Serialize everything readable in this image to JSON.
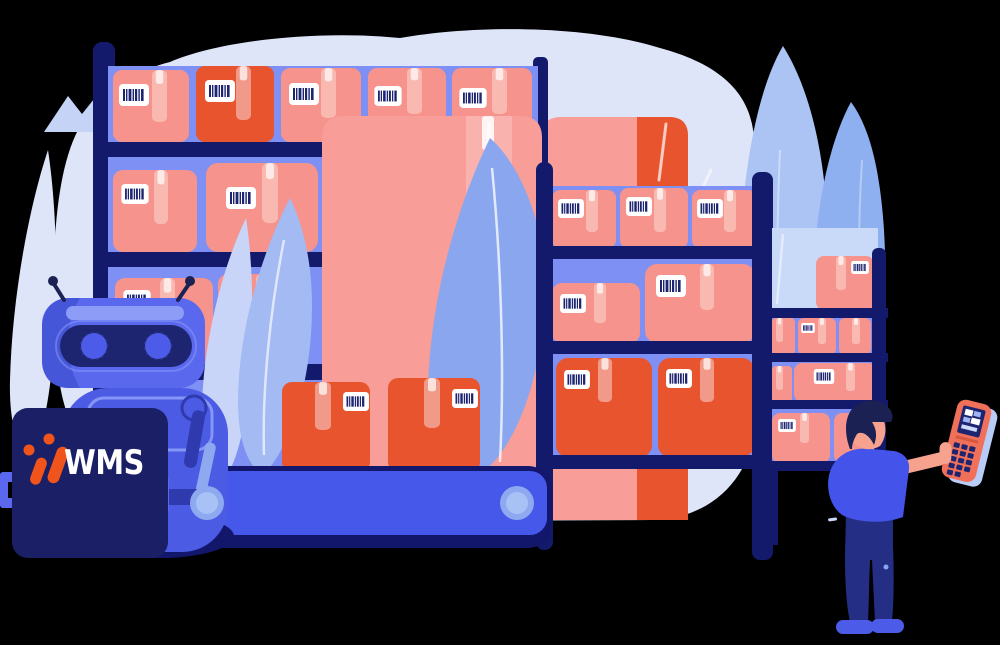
{
  "sign": {
    "logo_text": "WMS"
  },
  "palette": {
    "background": "#000000",
    "blob": "#dee5f8",
    "mound": "#c5d3f7",
    "teardrop_light": "#abc4f4",
    "teardrop_medium": "#8fb0f0",
    "leaf_light": "#c8d5f8",
    "leaf_medium": "#a3baf3",
    "leaf_big": "#8aa6ee",
    "shelf_panel": "#7e90f4",
    "shelf_panel_light": "#c9d9f8",
    "navy": "#131a6b",
    "box_salmon": "#f5938c",
    "box_orange": "#e8542d",
    "crate_pink": "#f89d97",
    "tape_salmon": "#f9b9b1",
    "tape_orange": "#f29a8a",
    "barcode_navy": "#1d2470",
    "conveyor_base": "#12176b",
    "conveyor_belt": "#4558ea",
    "roller_outer": "#8ea9ef",
    "roller_inner": "#a9c2f5",
    "robot_blue": "#5a68ee",
    "robot_dark": "#4656d8",
    "robot_body": "#4c5be4",
    "robot_highlight": "#8c9cf7",
    "visor_navy": "#1d2470",
    "eye_blue": "#4c5ce8",
    "sign_navy": "#1b2066",
    "logo_orange": "#f1541a",
    "logo_text_white": "#ffffff",
    "skin": "#f7a28f",
    "shirt": "#4453ea",
    "pants": "#252e85",
    "hair": "#1b2153",
    "shoe": "#4c5ce8",
    "scanner_orange": "#f0705a",
    "scanner_shadow": "#b9ccf8",
    "arm_navy": "#2e3aae"
  }
}
